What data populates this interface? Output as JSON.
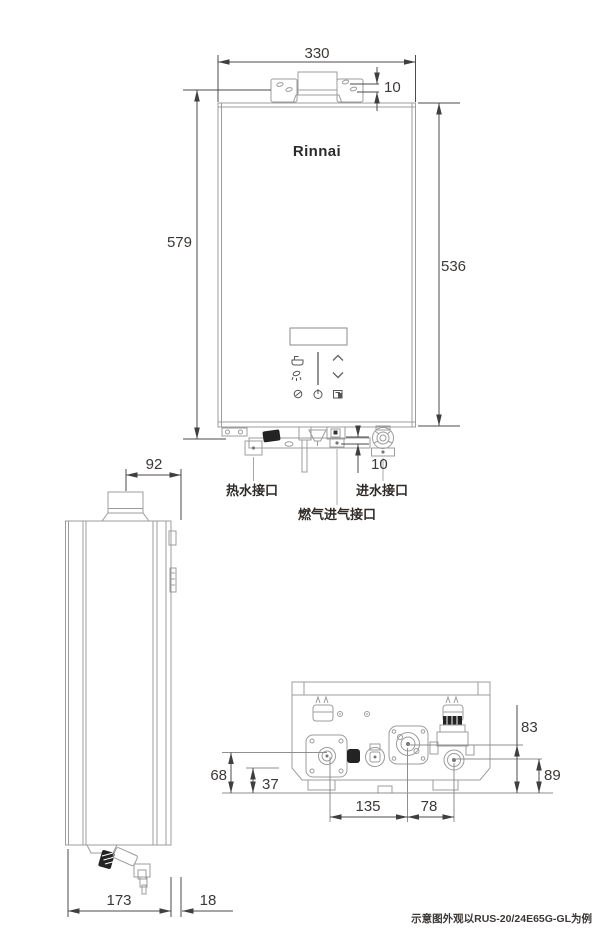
{
  "brand": "Rinnai",
  "note": "示意图外观以RUS-20/24E65G-GL为例",
  "colors": {
    "outline": "#9c9c9c",
    "dimension_line": "#4b4b4b",
    "text": "#3c3836",
    "dark_part": "#232323"
  },
  "front_view": {
    "dim_width": "330",
    "dim_bracket_hole_gap": "10",
    "dim_total_height": "579",
    "dim_body_height": "536",
    "dim_bottom_gap": "10",
    "label_hot_water": "热水接口",
    "label_water_inlet": "进水接口",
    "label_gas_inlet": "燃气进气接口"
  },
  "side_view": {
    "dim_flue_to_wall": "92",
    "dim_depth": "173",
    "dim_wall_gap": "18"
  },
  "bottom_view": {
    "dim_hot_water_height": "68",
    "dim_foot_height": "37",
    "dim_hot_to_gas": "135",
    "dim_gas_to_inlet": "78",
    "dim_gas_height": "83",
    "dim_inlet_height": "89"
  },
  "control_panel": {
    "icons": [
      "bath-icon",
      "shower-icon",
      "eco-icon",
      "power-icon",
      "up-icon",
      "down-icon",
      "mode-icon"
    ]
  }
}
